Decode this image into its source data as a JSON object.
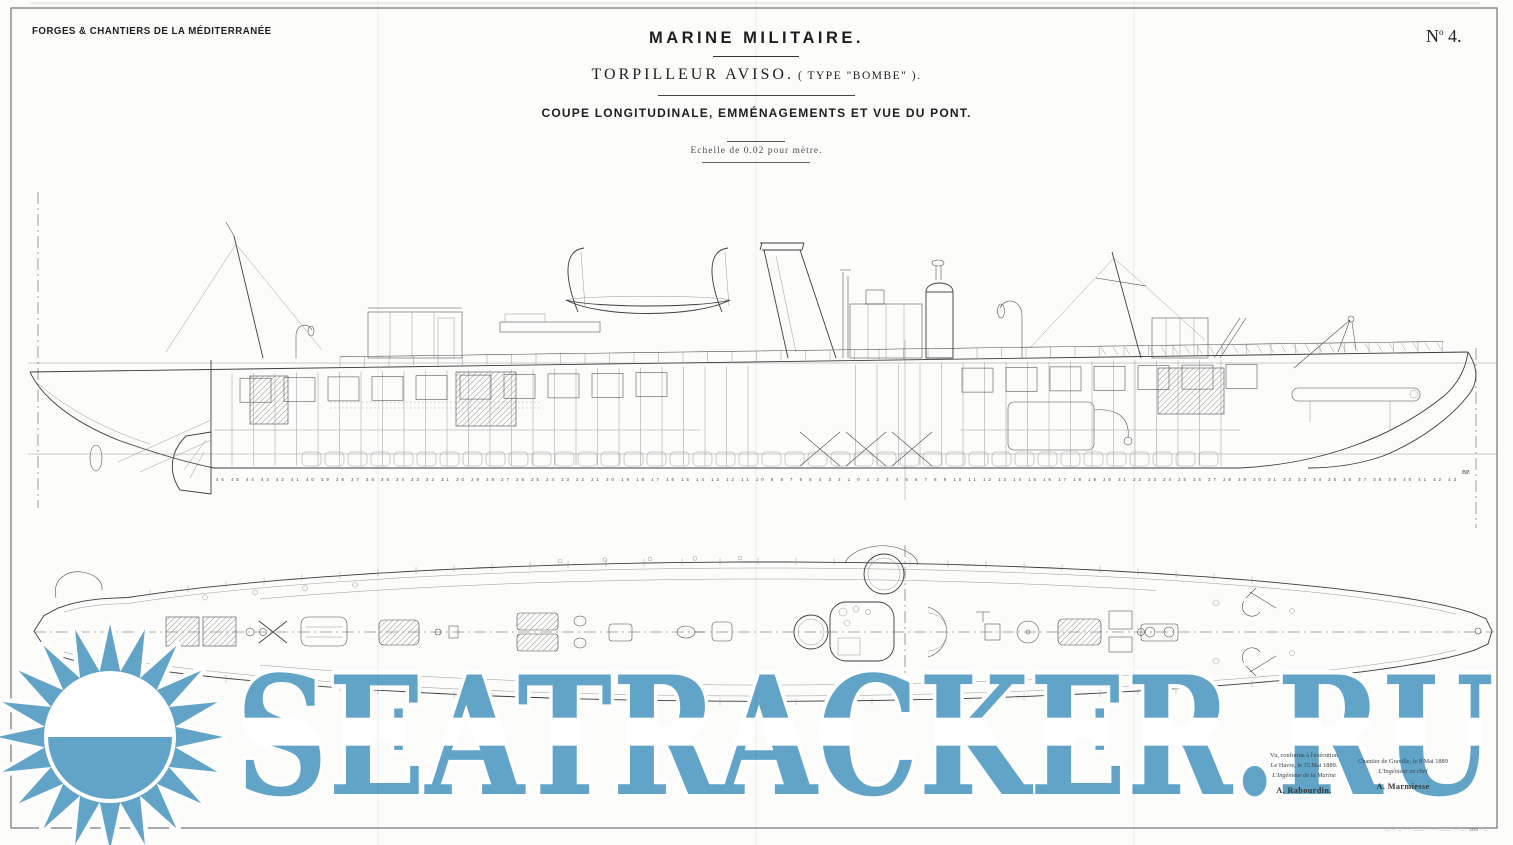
{
  "header": {
    "manufacturer": "FORGES & CHANTIERS DE LA MÉDITERRANÉE",
    "title": "MARINE MILITAIRE.",
    "subtitle_main": "TORPILLEUR AVISO.",
    "subtitle_paren": "( TYPE \"BOMBE\" ).",
    "view_caption": "COUPE LONGITUDINALE, EMMÉNAGEMENTS ET VUE DU PONT.",
    "scale_note": "Echelle de 0.02 pour mètre.",
    "plate": {
      "prefix": "N",
      "sup": "o",
      "number": "4."
    }
  },
  "side_view": {
    "bp_label": "BP.",
    "frame_numbers": "46 45 44 43 42 41 40 39 38 37 36 35 34 33 32 31 30 29 28 27 26 25 24 23 22 21 20 19 18 17 16 15 14 13 12 11 10 9 8 7 6 5 4 3 2 1 0 1 2 3 4 5 6 7 8 9 10 11 12 13 14 15 16 17 18 19 20 21 22 23 24 25 26 27 28 29 30 31 32 33 34 35 36 37 38 39 40 41 42 43"
  },
  "signatures": {
    "left": {
      "line1": "Vu, conforme à l'exécution",
      "line2": "Le Havre, le 15 Mai 1889.",
      "line3": "L'Ingénieur de la Marine",
      "name": "A. Rabourdin."
    },
    "right": {
      "line1": "Chantier de Graville, le 8 Mai 1889",
      "line2": "L'Ingénieur en chef",
      "name": "A. Marmiesse"
    }
  },
  "imprint": "·—· ··· — ···· · ——— ·· ····· ——— · ·· ·—·· 1889 ·· —",
  "watermark": {
    "text": "SEATRACKER.RU",
    "icon": "sun-icon",
    "color": "#62a4c8"
  }
}
